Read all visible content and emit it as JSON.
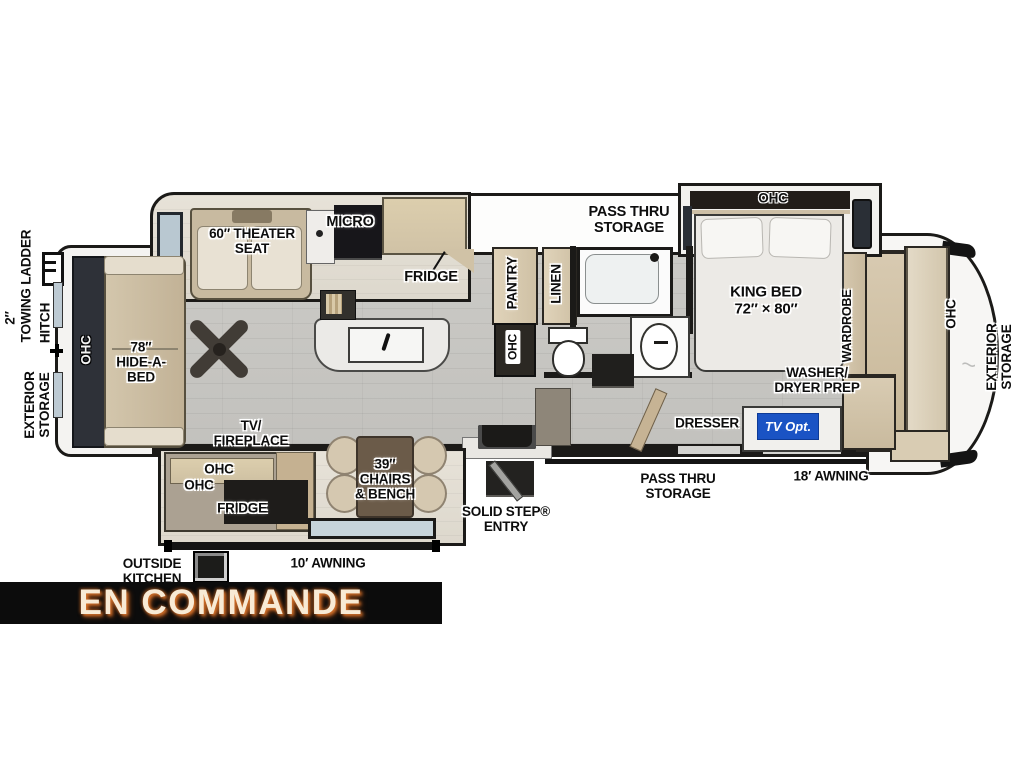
{
  "banner": {
    "text": "EN COMMANDE",
    "bg": "#0c0c0c",
    "text_color": "#f8ead5",
    "glow_color": "#e1782d"
  },
  "colors": {
    "wall": "#1b1a18",
    "floor": "#c8c7c3",
    "cabinet_tan": "#d6c8af",
    "tv_opt_blue": "#1a53c4"
  },
  "labels": {
    "towing": {
      "line1": "2″",
      "line2": "TOWING LADDER"
    },
    "hitch": "HITCH",
    "exterior_storage_left": {
      "line1": "EXTERIOR",
      "line2": "STORAGE"
    },
    "exterior_storage_right": {
      "line1": "EXTERIOR",
      "line2": "STORAGE"
    },
    "ohc_sofa": "OHC",
    "hide_a_bed": {
      "line1": "78″",
      "line2": "HIDE-A-",
      "line3": "BED"
    },
    "theater_seat": {
      "line1": "60″ THEATER",
      "line2": "SEAT"
    },
    "micro": "MICRO",
    "fridge_kitchen": "FRIDGE",
    "pass_thru_top": {
      "line1": "PASS THRU",
      "line2": "STORAGE"
    },
    "ohc_bed": "OHC",
    "king_bed": {
      "line1": "KING BED",
      "line2": "72″ × 80″"
    },
    "wardrobe": "WARDROBE",
    "ohc_front": "OHC",
    "pantry": "PANTRY",
    "ohc_pantry": "OHC",
    "linen": "LINEN",
    "washer_dryer": {
      "line1": "WASHER/",
      "line2": "DRYER PREP"
    },
    "dresser": "DRESSER",
    "tv_opt": "TV Opt.",
    "pass_thru_bottom": {
      "line1": "PASS THRU",
      "line2": "STORAGE"
    },
    "awning_18": "18′ AWNING",
    "solid_step": {
      "line1": "SOLID STEP®",
      "line2": "ENTRY"
    },
    "chairs_bench": {
      "line1": "39″",
      "line2": "CHAIRS",
      "line3": "& BENCH"
    },
    "tv_fireplace": {
      "line1": "TV/",
      "line2": "FIREPLACE"
    },
    "ohc_ent_1": "OHC",
    "ohc_ent_2": "OHC",
    "fridge_outside": "FRIDGE",
    "outside_kitchen": {
      "line1": "OUTSIDE",
      "line2": "KITCHEN"
    },
    "awning_10": "10′ AWNING"
  }
}
